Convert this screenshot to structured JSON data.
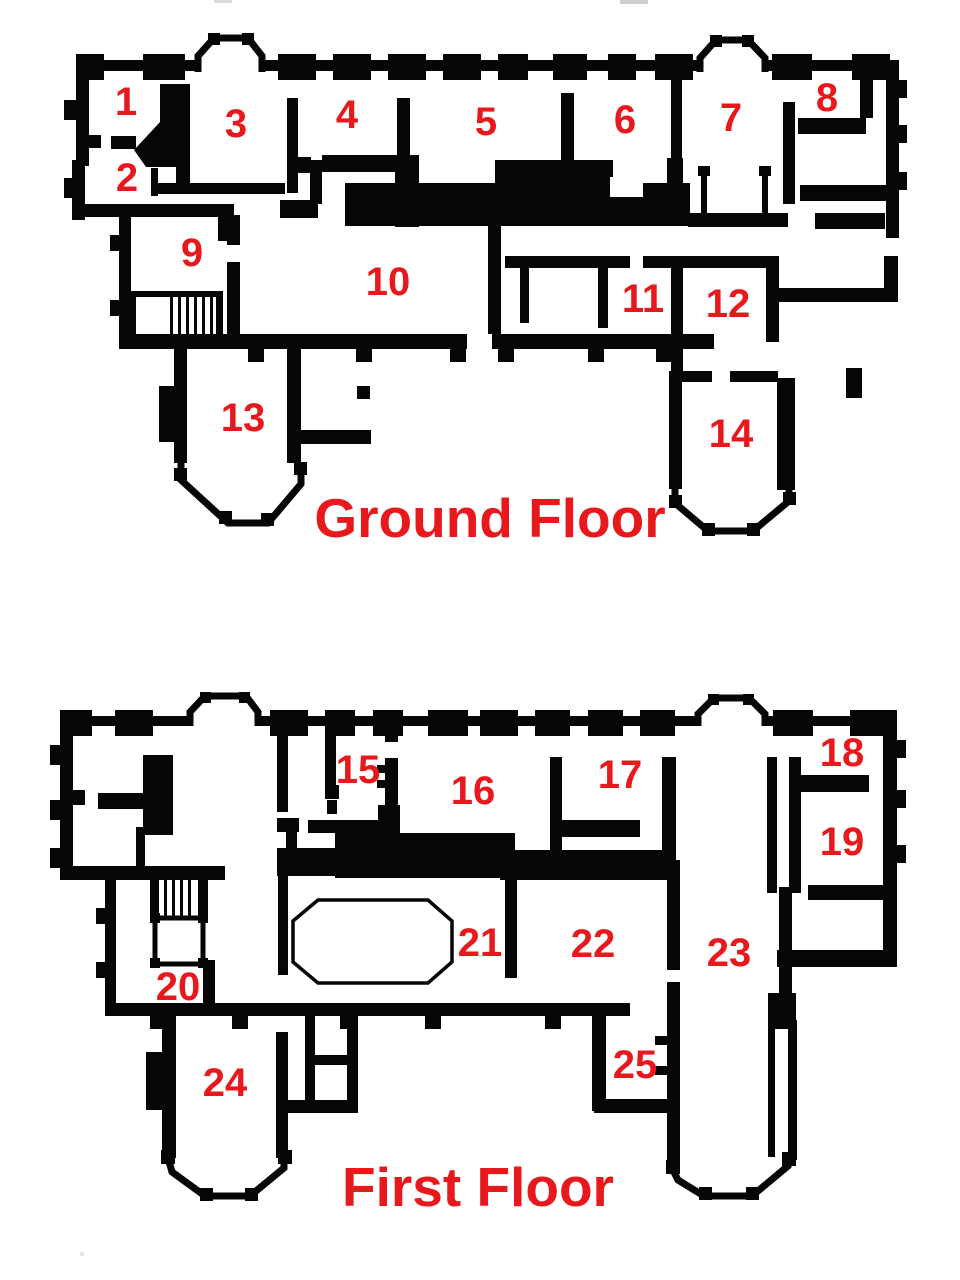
{
  "colors": {
    "label_red": "#e8191d",
    "wall_black": "#060606",
    "background": "#ffffff"
  },
  "ground_floor": {
    "title": "Ground Floor",
    "rooms": [
      {
        "number": "1"
      },
      {
        "number": "2"
      },
      {
        "number": "3"
      },
      {
        "number": "4"
      },
      {
        "number": "5"
      },
      {
        "number": "6"
      },
      {
        "number": "7"
      },
      {
        "number": "8"
      },
      {
        "number": "9"
      },
      {
        "number": "10"
      },
      {
        "number": "11"
      },
      {
        "number": "12"
      },
      {
        "number": "13"
      },
      {
        "number": "14"
      }
    ]
  },
  "first_floor": {
    "title": "First Floor",
    "rooms": [
      {
        "number": "15"
      },
      {
        "number": "16"
      },
      {
        "number": "17"
      },
      {
        "number": "18"
      },
      {
        "number": "19"
      },
      {
        "number": "20"
      },
      {
        "number": "21"
      },
      {
        "number": "22"
      },
      {
        "number": "23"
      },
      {
        "number": "24"
      },
      {
        "number": "25"
      }
    ]
  }
}
